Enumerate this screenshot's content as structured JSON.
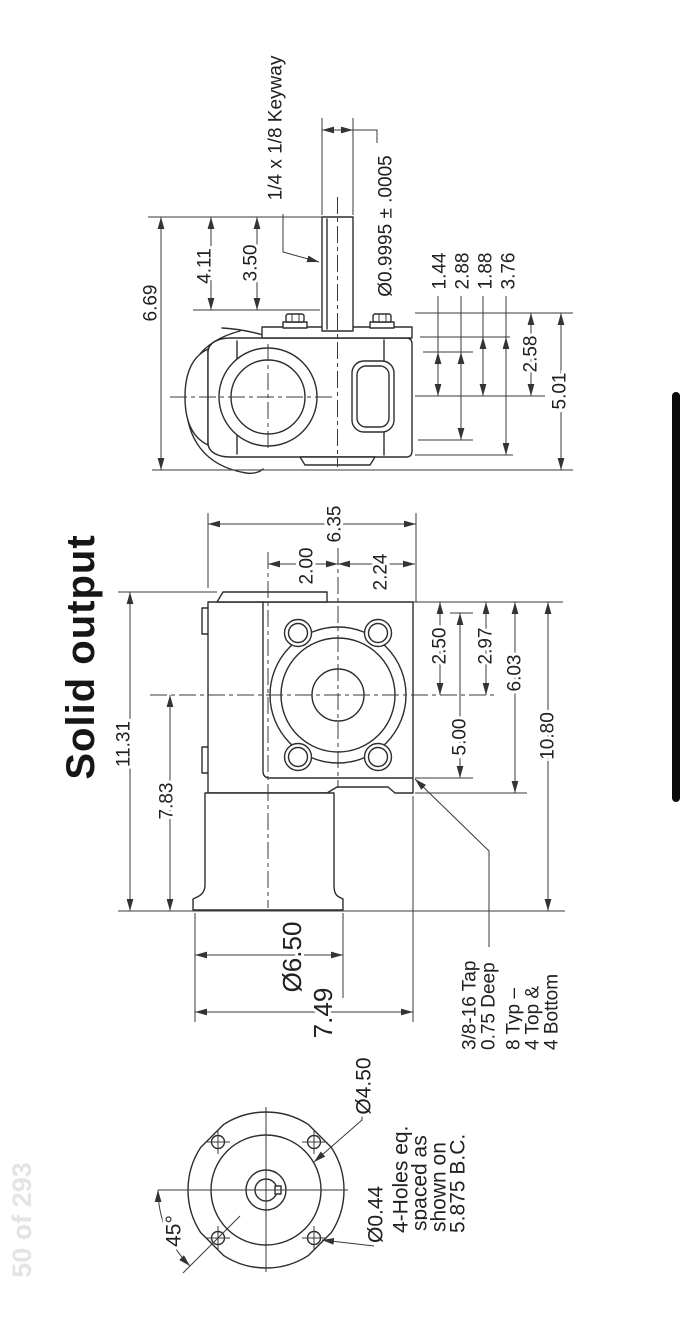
{
  "page": {
    "title": "Solid output",
    "watermark": "50 of 293"
  },
  "theme": {
    "line_color": "#2d2d2d",
    "text_color": "#202020",
    "scrollbar_color": "#0b0b0b",
    "watermark_color": "#e4e4e4",
    "background": "#ffffff"
  },
  "side_view": {
    "labels": {
      "keyway": "1/4 x 1/8 Keyway",
      "shaft_dia": "Ø0.9995 ± .0005",
      "d_669": "6.69",
      "d_411": "4.11",
      "d_350": "3.50",
      "d_144": "1.44",
      "d_288": "2.88",
      "d_188": "1.88",
      "d_376": "3.76",
      "d_258": "2.58",
      "d_501": "5.01"
    }
  },
  "front_view": {
    "labels": {
      "d_635": "6.35",
      "d_200": "2.00",
      "d_224": "2.24",
      "d_250": "2.50",
      "d_297": "2.97",
      "d_500": "5.00",
      "d_603": "6.03",
      "d_1080": "10.80",
      "d_1131": "11.31",
      "d_783": "7.83",
      "d_650": "Ø6.50",
      "d_749": "7.49"
    },
    "tap_note": {
      "line1": "3/8-16 Tap",
      "line2": "0.75 Deep",
      "line3": "8 Typ –",
      "line4": "4 Top &",
      "line5": "4 Bottom"
    }
  },
  "end_view": {
    "labels": {
      "d_450": "Ø4.50",
      "d_044": "Ø0.44",
      "angle": "45°"
    },
    "holes_note": {
      "line1": "4-Holes eq.",
      "line2": "spaced as",
      "line3": "shown on",
      "line4": "5.875 B.C."
    }
  }
}
